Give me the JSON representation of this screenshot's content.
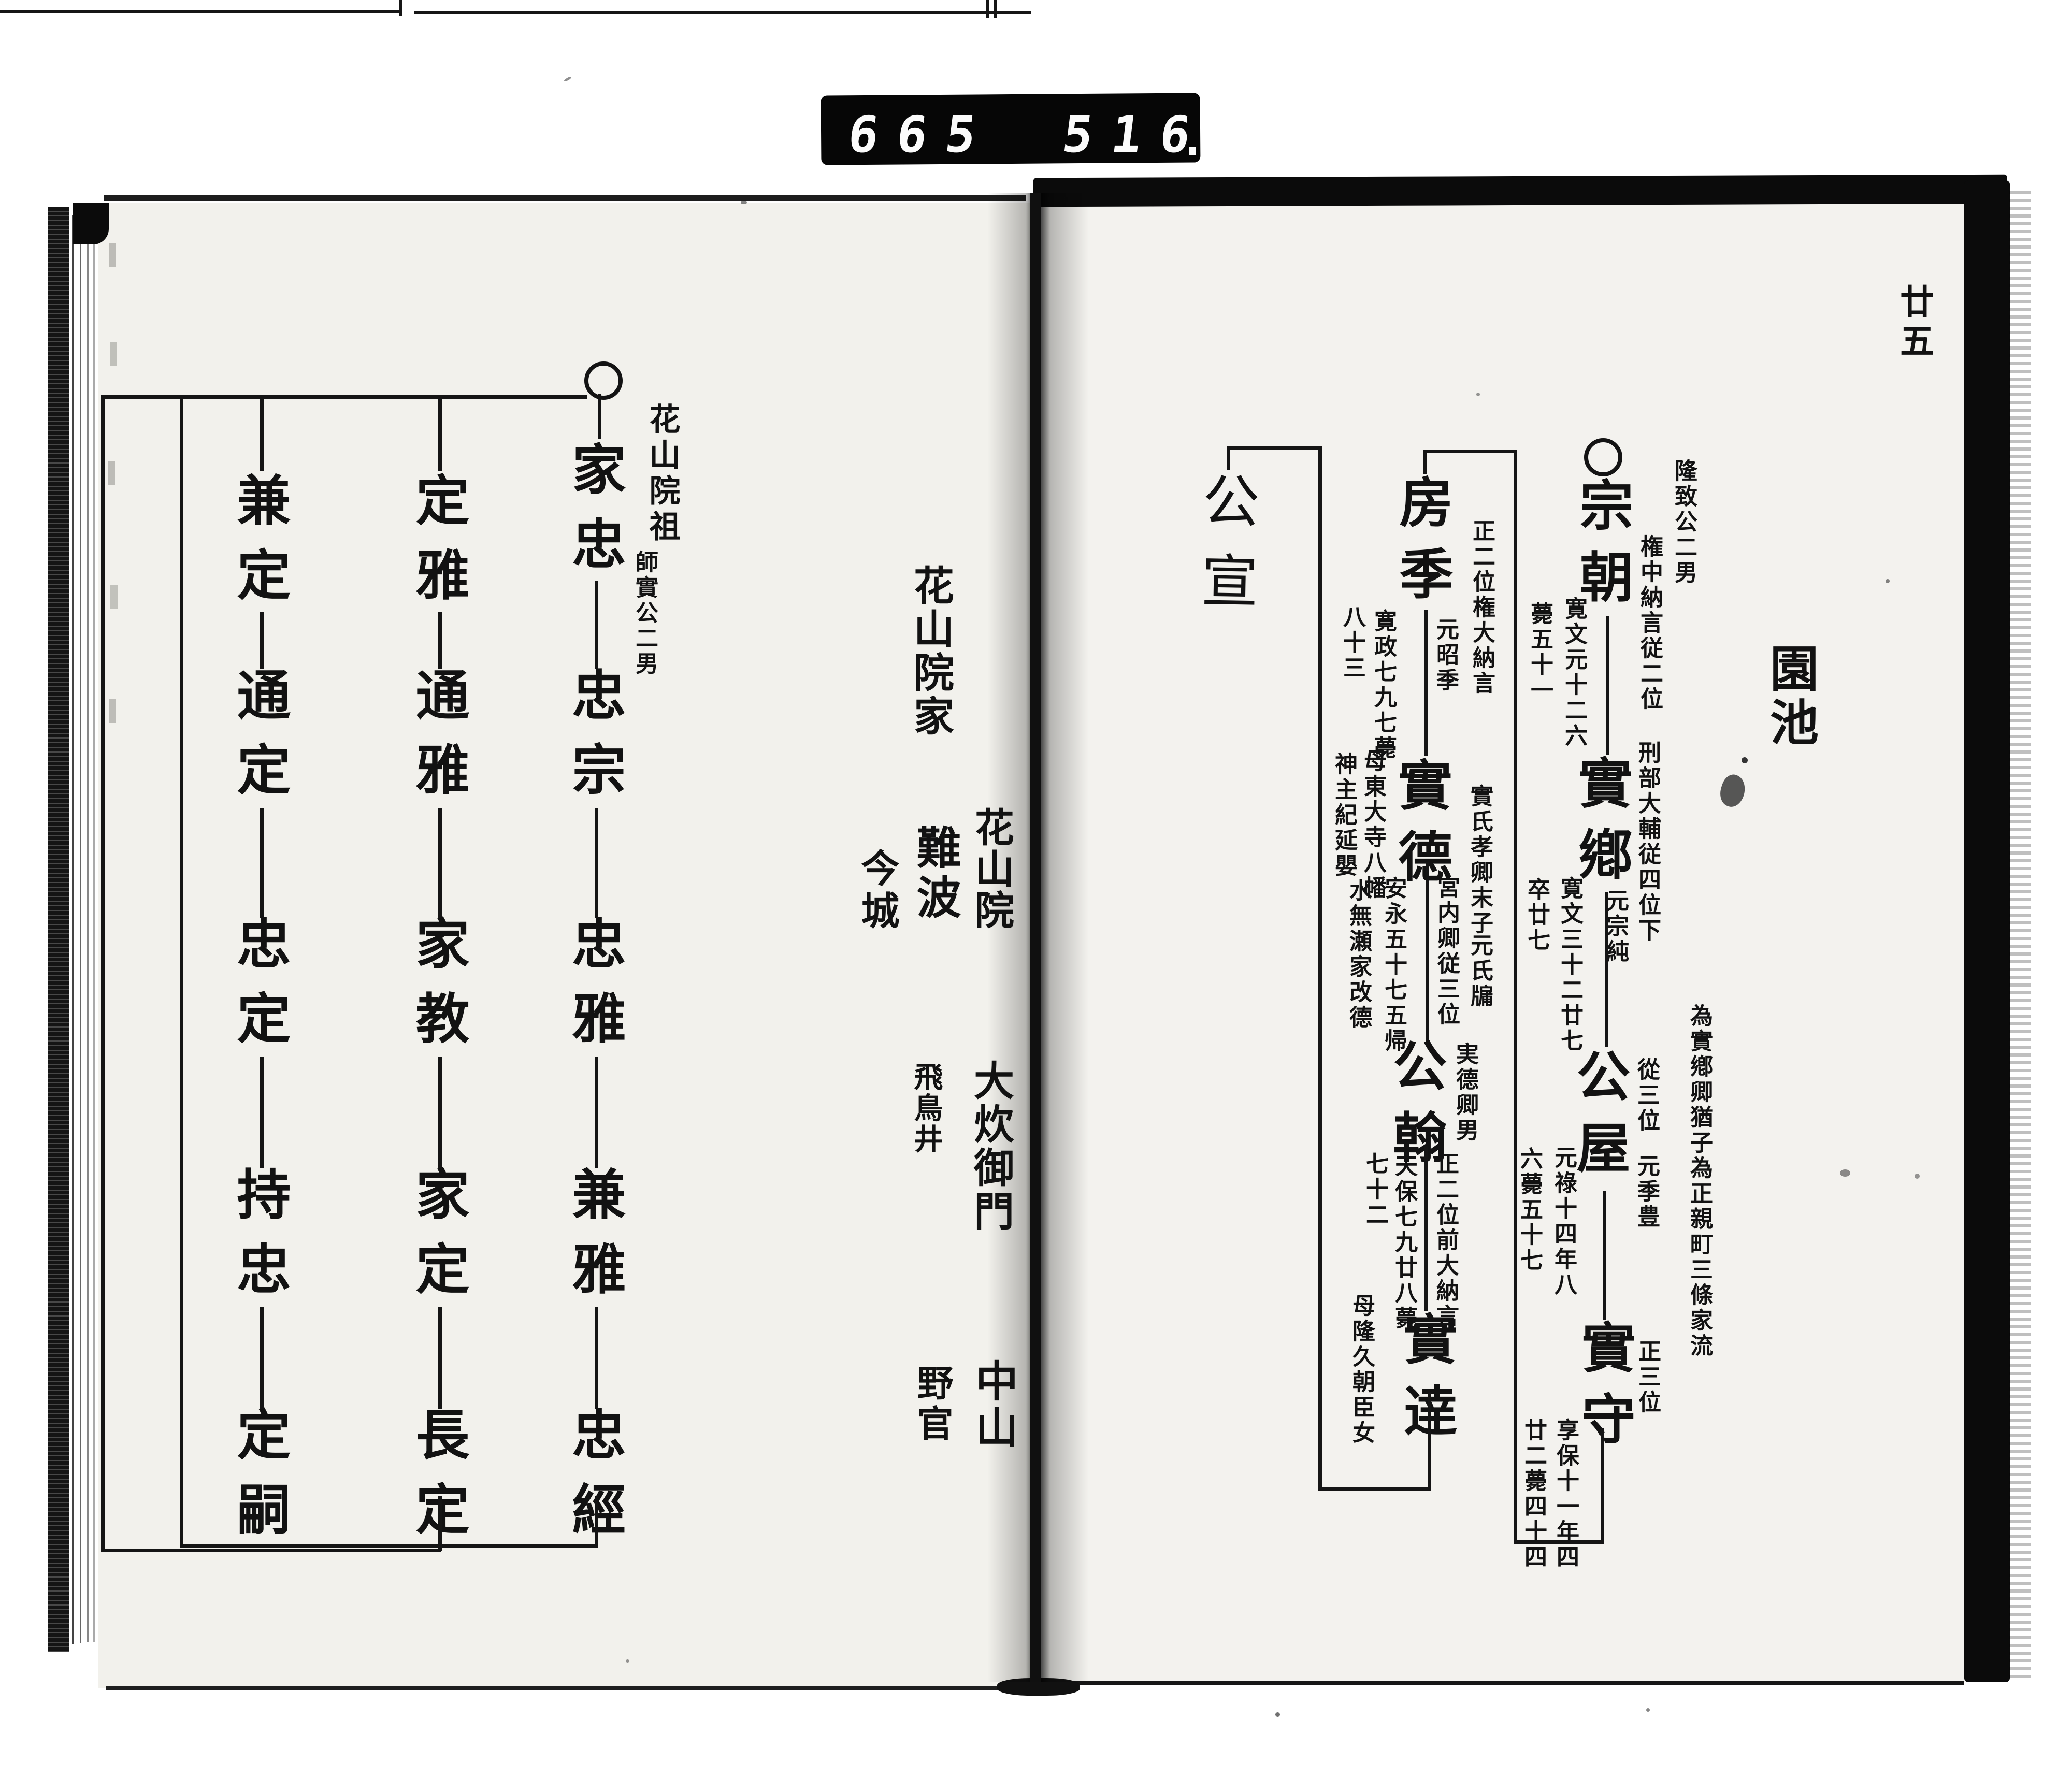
{
  "scanner": {
    "counter_left": "665",
    "counter_right": "516"
  },
  "page_number": "廿五",
  "right_page": {
    "family_heading": "園池",
    "generation1": {
      "name": "宗朝",
      "origin_note": "隆致公二男",
      "rank_note": "権中納言従二位",
      "death_date": "寛文元十二六",
      "death_age": "薨五十一"
    },
    "generation2": {
      "name": "實鄕",
      "rank_note": "刑部大輔従四位下",
      "orig_name": "元宗純",
      "death_date": "寛文三十二廿七",
      "death_age": "卒廿七"
    },
    "generation3": {
      "name": "公屋",
      "rank_note": "從三位",
      "orig_name": "元季豊",
      "adoption_note": "為實鄕卿猶子為正親町三條家流",
      "death_date": "元祿十四年八",
      "death_age": "六薨五十七"
    },
    "generation4": {
      "name": "實守",
      "rank_note": "正三位",
      "death_date": "享保十一年四",
      "death_age": "廿二薨四十四"
    },
    "generation5": {
      "name": "房季",
      "rank_note": "正二位権大納言",
      "orig_name": "元昭季",
      "death_date": "寛政七九七薨",
      "death_age": "八十三"
    },
    "generation6": {
      "name": "實德",
      "origin_note": "實氏孝卿末子",
      "orig_name": "元氏牖",
      "rank_note": "宮内卿従三位",
      "mother_note1": "母東大寺八幡",
      "mother_note2": "神主紀延嬰",
      "event_note1": "安永五十七五帰",
      "event_note2": "水無瀬家改德"
    },
    "generation7": {
      "name": "公翰",
      "origin_note": "実德卿男",
      "rank_note": "正二位前大納言",
      "death_date": "天保七九廿八薨",
      "death_age": "七十二"
    },
    "generation8": {
      "name": "實逹",
      "mother_note": "母隆久朝臣女"
    },
    "generation9": {
      "name": "公宣"
    }
  },
  "left_page": {
    "founder_label": "花山院祖",
    "founder_origin": "師實公二男",
    "column1": [
      "家忠",
      "忠宗",
      "忠雅",
      "兼雅",
      "忠經"
    ],
    "column2": [
      "定雅",
      "通雅",
      "家教",
      "家定",
      "長定"
    ],
    "column3": [
      "兼定",
      "通定",
      "忠定",
      "持忠",
      "定嗣"
    ],
    "family_labels_inner": [
      "花山院",
      "大炊御門",
      "中山"
    ],
    "family_labels_outer": [
      "花山院家",
      "難波",
      "飛鳥井",
      "野官"
    ],
    "family_label_far": "今城"
  }
}
